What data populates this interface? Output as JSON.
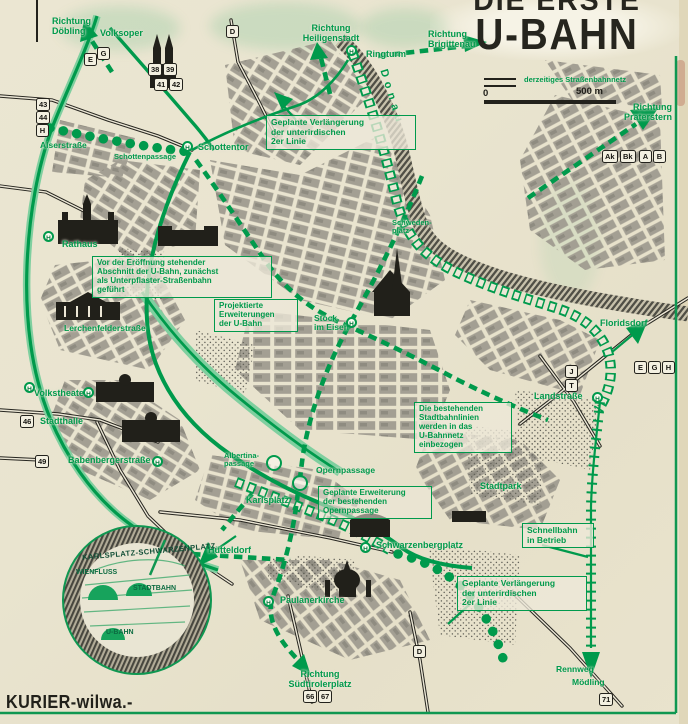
{
  "header": {
    "kicker": "DIE ERSTE",
    "title": "U-BAHN"
  },
  "legend": {
    "tram_label": "derzeitiges Straßenbahnnetz",
    "scale_zero": "0",
    "scale_label": "500 m"
  },
  "labels": {
    "richtung_doebling": "Richtung\nDöbling",
    "volksoper": "Volksoper",
    "richtung_heiligenstadt": "Richtung\nHeiligenstadt",
    "richtung_brigittenau": "Richtung\nBrigittenau",
    "ringturm": "Ringturm",
    "richtung_praterstern": "Richtung\nPraterstern",
    "donaukanal": "Donau",
    "schottentor": "Schottentor",
    "alserstrasse": "Alserstraße",
    "schottenpassage": "Schottenpassage",
    "rathaus": "Rathaus",
    "lerchenfelderstrasse": "Lerchenfelderstraße",
    "volkstheater": "Volkstheater",
    "stadthalle": "Stadthalle",
    "babenbergerstrasse": "Babenbergerstraße",
    "stock_im_eisen": "Stock\nim Eisen",
    "schwedenplatz": "Schweden-\nplatz",
    "karlsplatz": "Karlsplatz",
    "albertina_passage": "Albertina-\npassage",
    "opernpassage": "Opernpassage",
    "schwarzenbergplatz": "Schwarzenbergplatz",
    "stadtpark": "Stadtpark",
    "landstrasse": "Landstraße",
    "floridsdorf": "Floridsdorf",
    "huetteldorf": "Hütteldorf",
    "paulanerkirche": "Paulanerkirche",
    "richtung_suedtirolerplatz": "Richtung\nSüdtirolerplatz",
    "rennweg": "Rennweg",
    "moedling": "Mödling"
  },
  "annotations": {
    "north_extension": "Geplante Verlängerung\nder unterirdischen\n2er Linie",
    "pre_opening": "Vor der Eröffnung stehender\nAbschnitt der U-Bahn, zunächst\nals Unterpflaster-Straßenbahn\ngeführt",
    "projected_extensions": "Projektierte\nErweiterungen\nder U-Bahn",
    "stadtbahn_integration": "Die bestehenden\nStadtbahnlinien\nwerden in das\nU-Bahnnetz\neinbezogen",
    "schnellbahn_in_betrieb": "Schnellbahn\nin Betrieb",
    "south_extension": "Geplante Verlängerung\nder unterirdischen\n2er Linie",
    "opernpassage_extension": "Geplante Erweiterung\nder bestehenden\nOpernpassage"
  },
  "badges": {
    "e1": "E",
    "g1": "G",
    "n38": "38",
    "n39": "39",
    "n41": "41",
    "n42": "42",
    "d1": "D",
    "n43": "43",
    "n44": "44",
    "h1": "H",
    "n46": "46",
    "n49": "49",
    "ak": "Ak",
    "bk": "Bk",
    "a": "A",
    "b": "B",
    "e2": "E",
    "g2": "G",
    "h2": "H",
    "j": "J",
    "t": "T",
    "n66": "66",
    "n67": "67",
    "n71": "71",
    "d2": "D"
  },
  "stations": {
    "letter": "H"
  },
  "inset": {
    "title": "KARLSPLATZ-SCHWARZENPLATZ",
    "wienfluss": "WIENFLUSS",
    "stadtbahn": "STADTBAHN",
    "ubahn": "U-BAHN"
  },
  "footer": {
    "signature": "KURIER-wilwa.-"
  },
  "colors": {
    "green": "#009a4c",
    "paper": "#e9e4d0",
    "ink": "#21201a"
  }
}
